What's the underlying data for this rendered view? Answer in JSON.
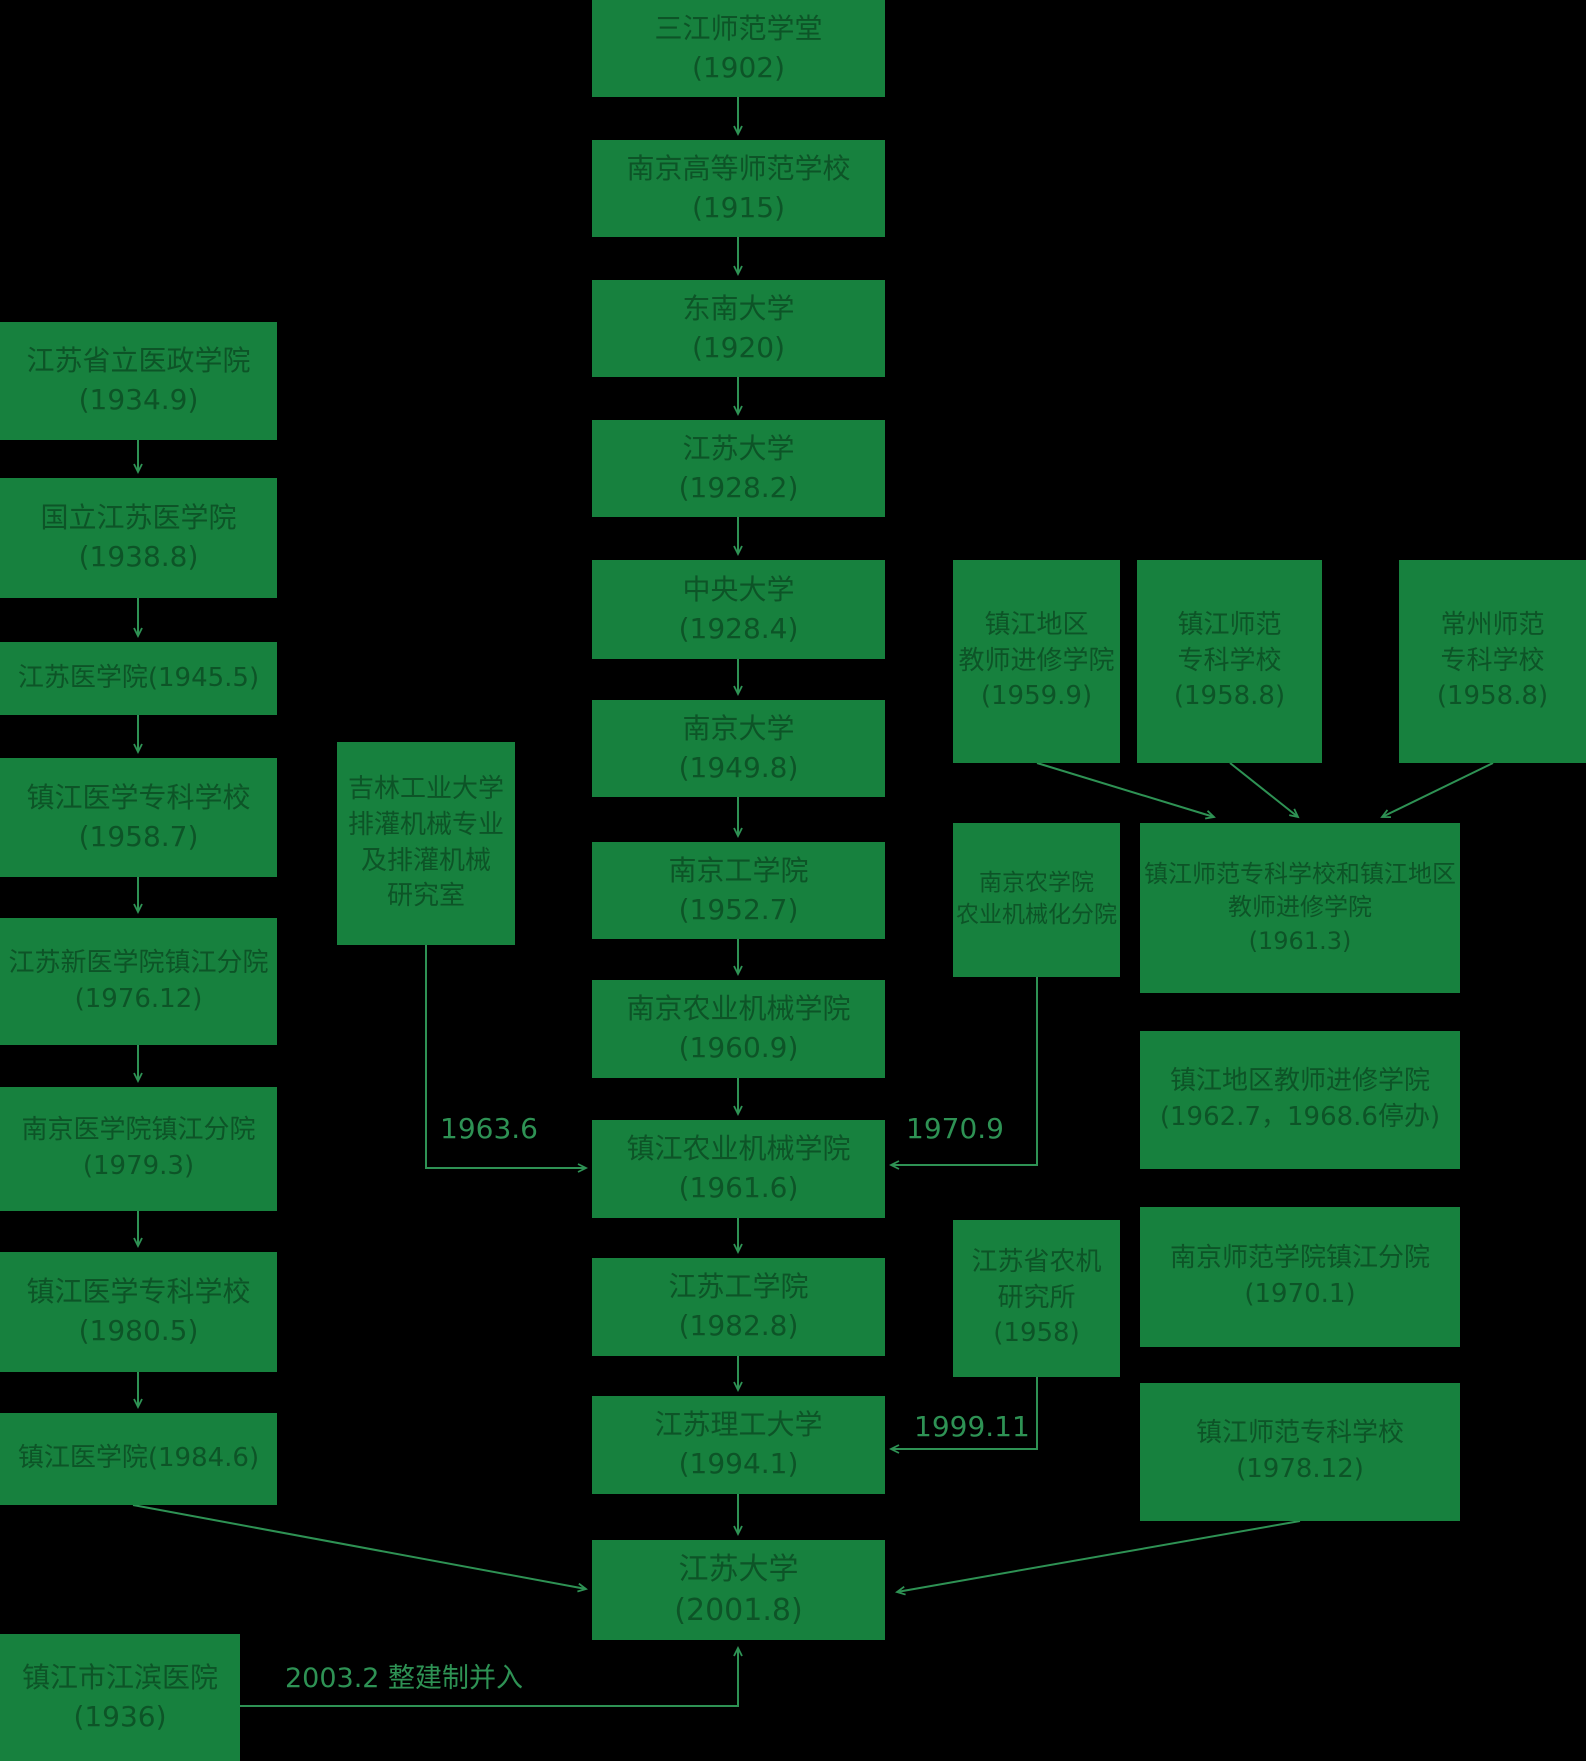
{
  "diagram_title": "江苏大学校史沿革图",
  "colors": {
    "background": "#000000",
    "box_fill": "#17813E",
    "box_text": "#0D5427",
    "connector": "#2E9254",
    "label_text": "#2E9254"
  },
  "boxes": [
    {
      "id": "sanjiang-normal-1902",
      "lines": [
        "三江师范学堂",
        "(1902)"
      ],
      "x": 592,
      "y": 0,
      "w": 293,
      "h": 97,
      "font": 28
    },
    {
      "id": "nanjing-higher-normal-1915",
      "lines": [
        "南京高等师范学校",
        "(1915)"
      ],
      "x": 592,
      "y": 140,
      "w": 293,
      "h": 97,
      "font": 28
    },
    {
      "id": "southeast-univ-1920",
      "lines": [
        "东南大学",
        "(1920)"
      ],
      "x": 592,
      "y": 280,
      "w": 293,
      "h": 97,
      "font": 28
    },
    {
      "id": "jiangsu-univ-1928",
      "lines": [
        "江苏大学",
        "(1928.2)"
      ],
      "x": 592,
      "y": 420,
      "w": 293,
      "h": 97,
      "font": 28
    },
    {
      "id": "central-univ-1928",
      "lines": [
        "中央大学",
        "(1928.4)"
      ],
      "x": 592,
      "y": 560,
      "w": 293,
      "h": 99,
      "font": 28
    },
    {
      "id": "nanjing-univ-1949",
      "lines": [
        "南京大学",
        "(1949.8)"
      ],
      "x": 592,
      "y": 700,
      "w": 293,
      "h": 97,
      "font": 28
    },
    {
      "id": "nanjing-inst-tech-1952",
      "lines": [
        "南京工学院",
        "(1952.7)"
      ],
      "x": 592,
      "y": 842,
      "w": 293,
      "h": 97,
      "font": 28
    },
    {
      "id": "nanjing-agri-machinery-1960",
      "lines": [
        "南京农业机械学院",
        "(1960.9)"
      ],
      "x": 592,
      "y": 980,
      "w": 293,
      "h": 98,
      "font": 28
    },
    {
      "id": "zhenjiang-agri-machinery-1961",
      "lines": [
        "镇江农业机械学院",
        "(1961.6)"
      ],
      "x": 592,
      "y": 1120,
      "w": 293,
      "h": 98,
      "font": 28
    },
    {
      "id": "jiangsu-inst-tech-1982",
      "lines": [
        "江苏工学院",
        "(1982.8)"
      ],
      "x": 592,
      "y": 1258,
      "w": 293,
      "h": 98,
      "font": 28
    },
    {
      "id": "jiangsu-univ-sci-tech-1994",
      "lines": [
        "江苏理工大学",
        "(1994.1)"
      ],
      "x": 592,
      "y": 1396,
      "w": 293,
      "h": 98,
      "font": 28
    },
    {
      "id": "jiangsu-univ-2001",
      "lines": [
        "江苏大学",
        "(2001.8)"
      ],
      "x": 592,
      "y": 1540,
      "w": 293,
      "h": 100,
      "font": 30
    },
    {
      "id": "jiangsu-medical-admin-1934",
      "lines": [
        "江苏省立医政学院",
        "(1934.9)"
      ],
      "x": 0,
      "y": 322,
      "w": 277,
      "h": 118,
      "font": 28
    },
    {
      "id": "national-jiangsu-medical-1938",
      "lines": [
        "国立江苏医学院",
        "(1938.8)"
      ],
      "x": 0,
      "y": 478,
      "w": 277,
      "h": 120,
      "font": 28
    },
    {
      "id": "jiangsu-medical-1945",
      "lines": [
        "江苏医学院(1945.5)"
      ],
      "x": 0,
      "y": 642,
      "w": 277,
      "h": 73,
      "font": 26
    },
    {
      "id": "zhenjiang-medical-college-1958",
      "lines": [
        "镇江医学专科学校",
        "(1958.7)"
      ],
      "x": 0,
      "y": 758,
      "w": 277,
      "h": 119,
      "font": 28
    },
    {
      "id": "jiangsu-new-medical-zhenjiang-1976",
      "lines": [
        "江苏新医学院镇江分院",
        "(1976.12)"
      ],
      "x": 0,
      "y": 918,
      "w": 277,
      "h": 127,
      "font": 26
    },
    {
      "id": "nanjing-medical-zhenjiang-1979",
      "lines": [
        "南京医学院镇江分院",
        "(1979.3)"
      ],
      "x": 0,
      "y": 1087,
      "w": 277,
      "h": 124,
      "font": 26
    },
    {
      "id": "zhenjiang-medical-college-1980",
      "lines": [
        "镇江医学专科学校",
        "(1980.5)"
      ],
      "x": 0,
      "y": 1252,
      "w": 277,
      "h": 120,
      "font": 28
    },
    {
      "id": "zhenjiang-medical-1984",
      "lines": [
        "镇江医学院(1984.6)"
      ],
      "x": 0,
      "y": 1413,
      "w": 277,
      "h": 92,
      "font": 26
    },
    {
      "id": "zhenjiang-jiangbin-hospital-1936",
      "lines": [
        "镇江市江滨医院",
        "(1936)"
      ],
      "x": 0,
      "y": 1634,
      "w": 240,
      "h": 127,
      "font": 28
    },
    {
      "id": "jilin-tech-irrigation-machinery",
      "lines": [
        "吉林工业大学",
        "排灌机械专业",
        "及排灌机械",
        "研究室"
      ],
      "x": 337,
      "y": 742,
      "w": 178,
      "h": 203,
      "font": 26
    },
    {
      "id": "zhenjiang-teachers-training-1959",
      "lines": [
        "镇江地区",
        "教师进修学院",
        "(1959.9)"
      ],
      "x": 953,
      "y": 560,
      "w": 167,
      "h": 203,
      "font": 26
    },
    {
      "id": "zhenjiang-normal-college-1958",
      "lines": [
        "镇江师范",
        "专科学校",
        "(1958.8)"
      ],
      "x": 1137,
      "y": 560,
      "w": 185,
      "h": 203,
      "font": 26
    },
    {
      "id": "changzhou-normal-college-1958",
      "lines": [
        "常州师范",
        "专科学校",
        "(1958.8)"
      ],
      "x": 1399,
      "y": 560,
      "w": 187,
      "h": 203,
      "font": 26
    },
    {
      "id": "zhenjiang-normal-merged-1961",
      "lines": [
        "镇江师范专科学校和镇江地区",
        "教师进修学院",
        "(1961.3)"
      ],
      "x": 1140,
      "y": 823,
      "w": 320,
      "h": 170,
      "font": 24
    },
    {
      "id": "zhenjiang-teachers-training-1962",
      "lines": [
        "镇江地区教师进修学院",
        "(1962.7，1968.6停办)"
      ],
      "x": 1140,
      "y": 1031,
      "w": 320,
      "h": 138,
      "font": 26
    },
    {
      "id": "nanjing-normal-zhenjiang-1970",
      "lines": [
        "南京师范学院镇江分院",
        "(1970.1)"
      ],
      "x": 1140,
      "y": 1207,
      "w": 320,
      "h": 140,
      "font": 26
    },
    {
      "id": "zhenjiang-normal-college-1978",
      "lines": [
        "镇江师范专科学校",
        "(1978.12)"
      ],
      "x": 1140,
      "y": 1383,
      "w": 320,
      "h": 138,
      "font": 26
    },
    {
      "id": "nanjing-agri-mechanization-branch",
      "lines": [
        "南京农学院",
        "农业机械化分院"
      ],
      "x": 953,
      "y": 823,
      "w": 167,
      "h": 154,
      "font": 23
    },
    {
      "id": "jiangsu-agri-machinery-inst-1958",
      "lines": [
        "江苏省农机",
        "研究所",
        "(1958)"
      ],
      "x": 953,
      "y": 1220,
      "w": 167,
      "h": 157,
      "font": 26
    }
  ],
  "edges": [
    {
      "name": "c1-c2",
      "points": [
        [
          738,
          97
        ],
        [
          738,
          134
        ]
      ]
    },
    {
      "name": "c2-c3",
      "points": [
        [
          738,
          237
        ],
        [
          738,
          274
        ]
      ]
    },
    {
      "name": "c3-c4",
      "points": [
        [
          738,
          377
        ],
        [
          738,
          414
        ]
      ]
    },
    {
      "name": "c4-c5",
      "points": [
        [
          738,
          517
        ],
        [
          738,
          554
        ]
      ]
    },
    {
      "name": "c5-c6",
      "points": [
        [
          738,
          659
        ],
        [
          738,
          694
        ]
      ]
    },
    {
      "name": "c6-c7",
      "points": [
        [
          738,
          797
        ],
        [
          738,
          836
        ]
      ]
    },
    {
      "name": "c7-c8",
      "points": [
        [
          738,
          939
        ],
        [
          738,
          974
        ]
      ]
    },
    {
      "name": "c8-c9",
      "points": [
        [
          738,
          1078
        ],
        [
          738,
          1114
        ]
      ]
    },
    {
      "name": "c9-c10",
      "points": [
        [
          738,
          1218
        ],
        [
          738,
          1252
        ]
      ]
    },
    {
      "name": "c10-c11",
      "points": [
        [
          738,
          1356
        ],
        [
          738,
          1390
        ]
      ]
    },
    {
      "name": "c11-c12",
      "points": [
        [
          738,
          1494
        ],
        [
          738,
          1534
        ]
      ]
    },
    {
      "name": "l1-l2",
      "points": [
        [
          138,
          440
        ],
        [
          138,
          472
        ]
      ]
    },
    {
      "name": "l2-l3",
      "points": [
        [
          138,
          598
        ],
        [
          138,
          636
        ]
      ]
    },
    {
      "name": "l3-l4",
      "points": [
        [
          138,
          715
        ],
        [
          138,
          752
        ]
      ]
    },
    {
      "name": "l4-l5",
      "points": [
        [
          138,
          877
        ],
        [
          138,
          912
        ]
      ]
    },
    {
      "name": "l5-l6",
      "points": [
        [
          138,
          1045
        ],
        [
          138,
          1081
        ]
      ]
    },
    {
      "name": "l6-l7",
      "points": [
        [
          138,
          1211
        ],
        [
          138,
          1246
        ]
      ]
    },
    {
      "name": "l7-l8",
      "points": [
        [
          138,
          1372
        ],
        [
          138,
          1407
        ]
      ]
    },
    {
      "name": "l8-final",
      "points": [
        [
          133,
          1505
        ],
        [
          586,
          1589
        ]
      ]
    },
    {
      "name": "r4-final",
      "points": [
        [
          1300,
          1521
        ],
        [
          897,
          1592
        ]
      ]
    },
    {
      "name": "jilin-1963-merge",
      "points": [
        [
          426,
          945
        ],
        [
          426,
          1168
        ],
        [
          586,
          1168
        ]
      ]
    },
    {
      "name": "nongji-branch-1970-merge",
      "points": [
        [
          1037,
          977
        ],
        [
          1037,
          1165
        ],
        [
          891,
          1165
        ]
      ]
    },
    {
      "name": "nongji-inst-1999-merge",
      "points": [
        [
          1037,
          1377
        ],
        [
          1037,
          1449
        ],
        [
          891,
          1449
        ]
      ]
    },
    {
      "name": "hospital-2003-merge",
      "points": [
        [
          240,
          1706
        ],
        [
          738,
          1706
        ],
        [
          738,
          1648
        ]
      ]
    },
    {
      "name": "ra-r1",
      "points": [
        [
          1037,
          763
        ],
        [
          1214,
          817
        ]
      ]
    },
    {
      "name": "rb-r1",
      "points": [
        [
          1230,
          763
        ],
        [
          1298,
          817
        ]
      ]
    },
    {
      "name": "rc-r1",
      "points": [
        [
          1493,
          763
        ],
        [
          1382,
          817
        ]
      ]
    }
  ],
  "edge_labels": [
    {
      "id": "label-1963-6",
      "text": "1963.6",
      "x": 440,
      "y": 1112,
      "font": 28
    },
    {
      "id": "label-1970-9",
      "text": "1970.9",
      "x": 906,
      "y": 1112,
      "font": 28
    },
    {
      "id": "label-1999-11",
      "text": "1999.11",
      "x": 914,
      "y": 1410,
      "font": 28
    },
    {
      "id": "label-2003-2",
      "text": "2003.2  整建制并入",
      "x": 285,
      "y": 1656,
      "font": 27
    }
  ]
}
